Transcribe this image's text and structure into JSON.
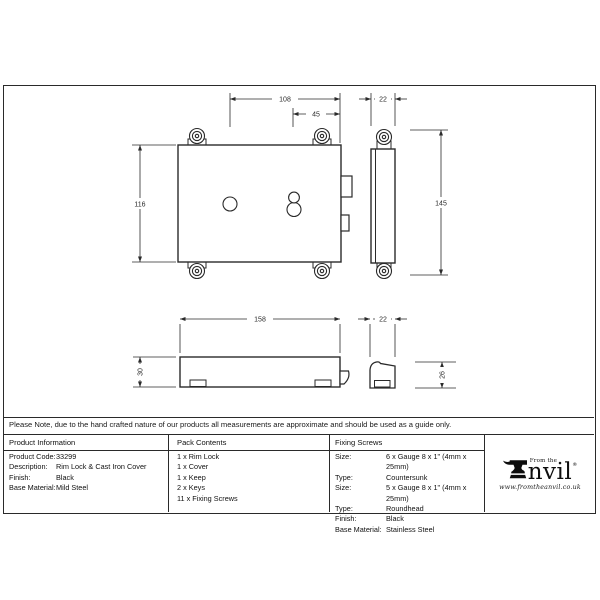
{
  "note": "Please Note, due to the hand crafted nature of our products all measurements are approximate and should be used as a guide only.",
  "drawing": {
    "front_view": {
      "width": "108",
      "keyhole_backset": "45",
      "height": "116"
    },
    "side_view": {
      "width": "22",
      "height": "145"
    },
    "plan_view": {
      "length": "158",
      "depth": "30"
    },
    "keep": {
      "width": "22",
      "height": "26"
    }
  },
  "tables": {
    "product_information": {
      "title": "Product Information",
      "rows": [
        {
          "label": "Product Code:",
          "value": "33299"
        },
        {
          "label": "Description:",
          "value": "Rim Lock & Cast Iron Cover"
        },
        {
          "label": "Finish:",
          "value": "Black"
        },
        {
          "label": "Base Material:",
          "value": "Mild Steel"
        }
      ]
    },
    "pack_contents": {
      "title": "Pack Contents",
      "items": [
        "1 x Rim Lock",
        "1 x Cover",
        "1 x Keep",
        "2 x Keys",
        "11 x Fixing Screws"
      ]
    },
    "fixing_screws": {
      "title": "Fixing Screws",
      "rows": [
        {
          "label": "Size:",
          "value": "6 x Gauge 8 x 1\" (4mm x 25mm)"
        },
        {
          "label": "Type:",
          "value": "Countersunk"
        },
        {
          "label": "Size:",
          "value": "5 x Gauge 8 x 1\" (4mm x 25mm)"
        },
        {
          "label": "Type:",
          "value": "Roundhead"
        },
        {
          "label": "Finish:",
          "value": "Black"
        },
        {
          "label": "Base Material:",
          "value": "Stainless Steel"
        }
      ]
    }
  },
  "brand": {
    "from_the": "From the",
    "name_rest": "nvil",
    "registered": "®",
    "website": "www.fromtheanvil.co.uk"
  },
  "colors": {
    "line": "#2a2a2a",
    "paper": "#ffffff",
    "ink": "#111111"
  }
}
